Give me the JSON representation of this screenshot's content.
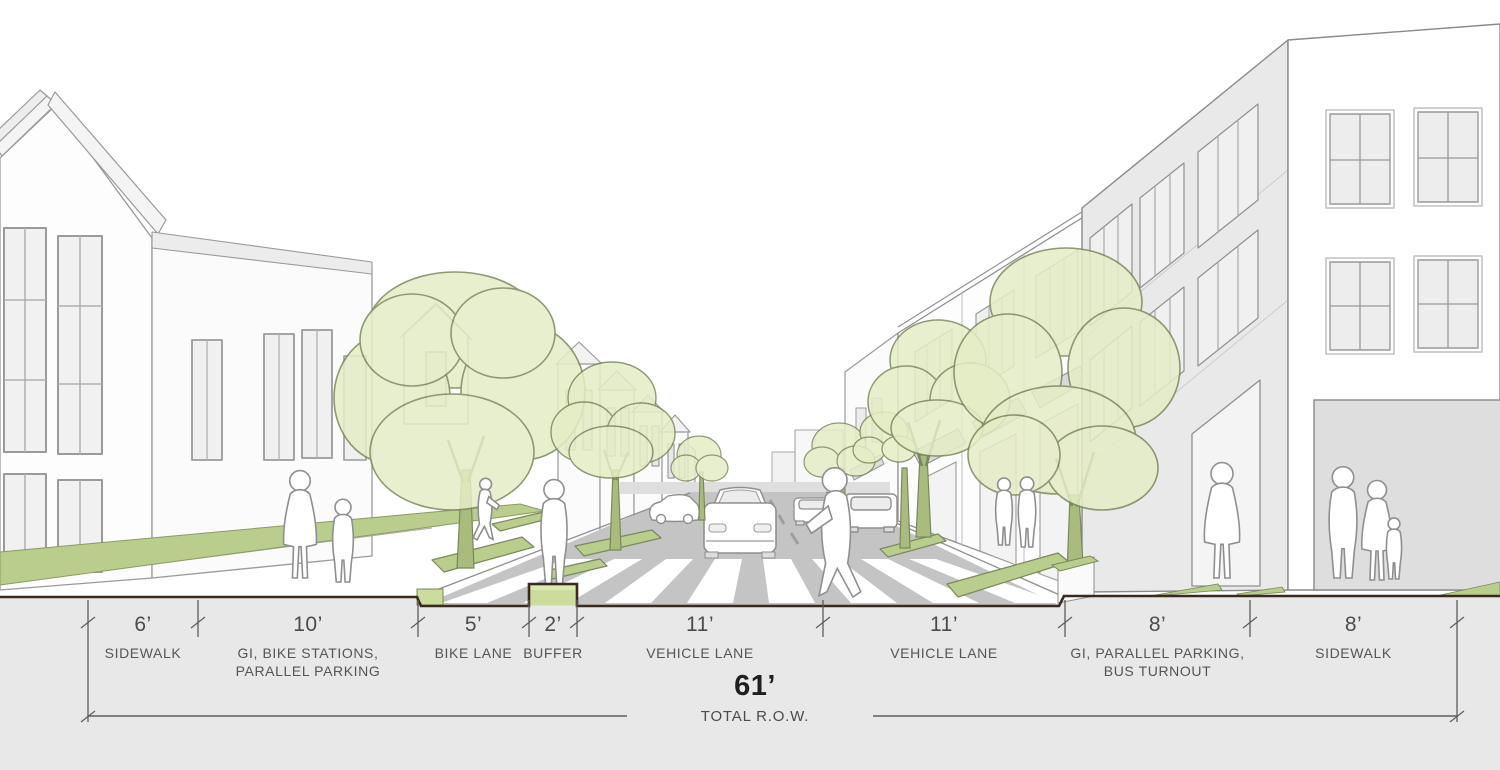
{
  "scene": {
    "description": "Perspective rendering of a neighborhood street cross-section with houses on the left, commercial buildings on the right, street trees, green infrastructure strips, a bike lane with cyclist, parked cars, a vehicle approaching a crosswalk and pedestrians",
    "colors": {
      "tree_canopy": "#e5edc6",
      "tree_outline": "#79885c",
      "grass": "#b9cd8d",
      "buffer_green": "#ccdc9c",
      "road_gray": "#c4c4c5",
      "building_gray": "#e9e9ea",
      "section_gray": "#e8e8e9",
      "section_edge": "#3a2a1e",
      "line_gray": "#8f8f8f",
      "text_gray": "#4b4b4b"
    }
  },
  "dimensions": {
    "segments": [
      {
        "value": "6’",
        "label": "SIDEWALK",
        "x1": 88,
        "x2": 198
      },
      {
        "value": "10’",
        "label": "GI, BIKE STATIONS,\nPARALLEL PARKING",
        "x1": 198,
        "x2": 418
      },
      {
        "value": "5’",
        "label": "BIKE LANE",
        "x1": 418,
        "x2": 529
      },
      {
        "value": "2’",
        "label": "BUFFER",
        "x1": 529,
        "x2": 577
      },
      {
        "value": "11’",
        "label": "VEHICLE LANE",
        "x1": 577,
        "x2": 823
      },
      {
        "value": "11’",
        "label": "VEHICLE LANE",
        "x1": 823,
        "x2": 1065
      },
      {
        "value": "8’",
        "label": "GI, PARALLEL PARKING,\nBUS TURNOUT",
        "x1": 1065,
        "x2": 1250
      },
      {
        "value": "8’",
        "label": "SIDEWALK",
        "x1": 1250,
        "x2": 1457
      }
    ],
    "total": {
      "value": "61’",
      "label": "TOTAL R.O.W.",
      "x1": 88,
      "x2": 1457,
      "gap_x1": 627,
      "gap_x2": 873,
      "line_y": 716,
      "center_x": 755
    }
  }
}
